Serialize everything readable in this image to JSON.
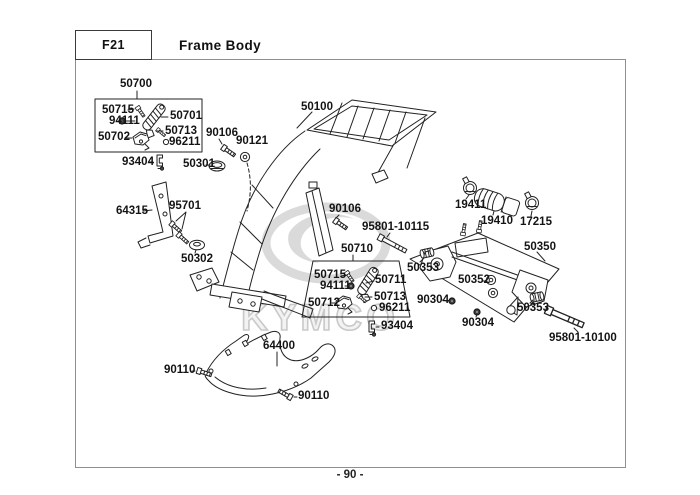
{
  "header": {
    "code": "F21",
    "title": "Frame Body"
  },
  "footer": {
    "page_number": "- 90 -"
  },
  "watermark": {
    "brand": "KYMCO"
  },
  "labels": {
    "l50700": "50700",
    "l50715a": "50715",
    "l94111a": "94111",
    "l50701": "50701",
    "l50702": "50702",
    "l50713a": "50713",
    "l96211a": "96211",
    "l93404a": "93404",
    "l50301": "50301",
    "l90106a": "90106",
    "l90121": "90121",
    "l50100": "50100",
    "l64315": "64315",
    "l95701": "95701",
    "l50302": "50302",
    "l90106b": "90106",
    "l95801_10115": "95801-10115",
    "l50710": "50710",
    "l50715b": "50715",
    "l94111b": "94111",
    "l50711": "50711",
    "l50712": "50712",
    "l50713b": "50713",
    "l96211b": "96211",
    "l93404b": "93404",
    "l19411": "19411",
    "l19410": "19410",
    "l17215": "17215",
    "l50350": "50350",
    "l50353a": "50353",
    "l50352": "50352",
    "l90304a": "90304",
    "l90304b": "90304",
    "l50353b": "50353",
    "l95801_10100": "95801-10100",
    "l64400": "64400",
    "l90110a": "90110",
    "l90110b": "90110"
  }
}
